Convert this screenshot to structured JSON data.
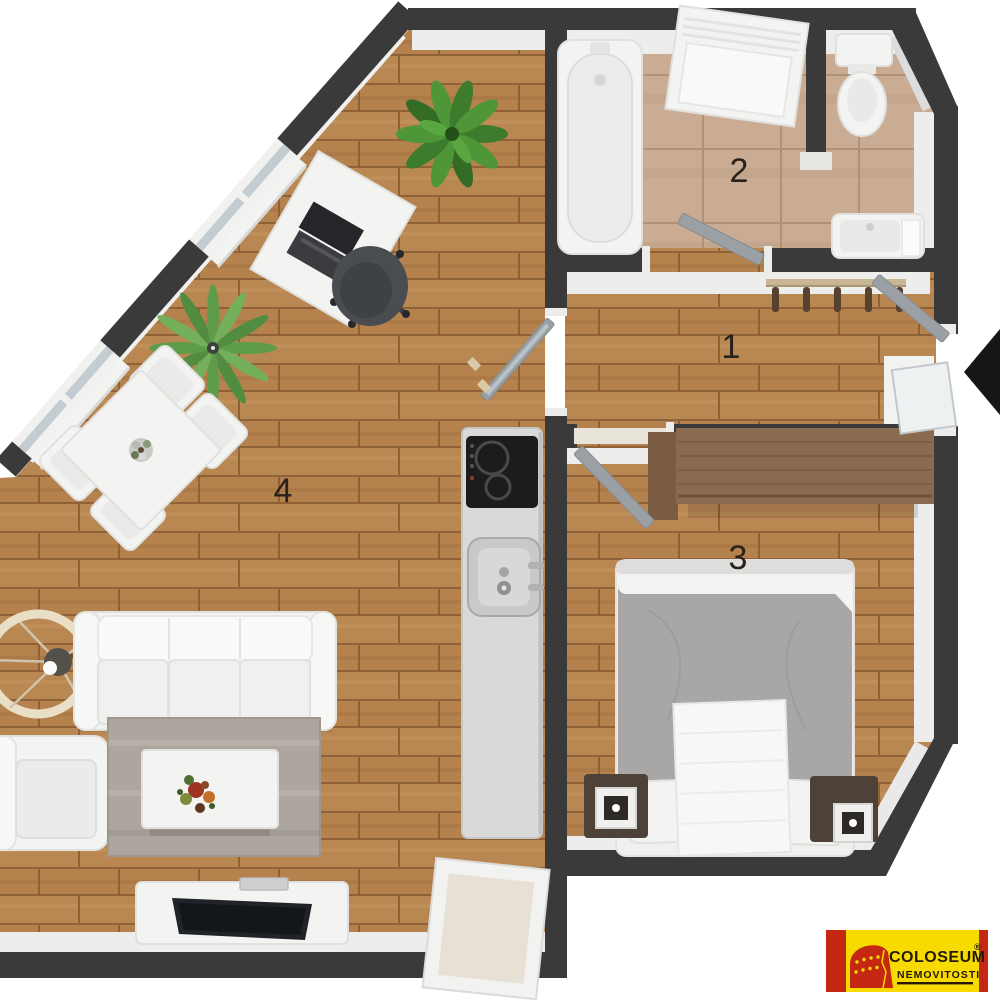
{
  "rooms": {
    "hall": {
      "label": "1"
    },
    "bathroom": {
      "label": "2"
    },
    "bedroom": {
      "label": "3"
    },
    "living_room": {
      "label": "4"
    }
  },
  "logo": {
    "brand": "COLOSEUM",
    "registered_mark": "®",
    "subtitle": "NEMOVITOSTI"
  },
  "icons": {
    "entrance_arrow": "left-pointing-arrowhead",
    "logo_mark": "colosseum-building"
  },
  "furniture": {
    "bathroom": [
      "bathtub",
      "shower-unit",
      "toilet",
      "wc-partition",
      "wash-basin"
    ],
    "hall": [
      "coat-rack",
      "entrance-door",
      "entrance-sidelight"
    ],
    "bedroom": [
      "wardrobe",
      "double-bed",
      "pillows",
      "white-runner",
      "nightstand-left",
      "nightstand-right",
      "bedroom-door"
    ],
    "living_room": [
      "desk",
      "laptop",
      "office-chair",
      "potted-plant",
      "fern-plant",
      "dining-table",
      "dining-chair-north",
      "dining-chair-east",
      "dining-chair-south",
      "dining-chair-west",
      "flower-centerpiece",
      "pendant-lamp",
      "sofa",
      "armchair",
      "rug",
      "coffee-table",
      "flower-bouquet",
      "tv-stand",
      "tv",
      "balcony-door",
      "glass-door"
    ],
    "kitchen": [
      "kitchen-counter",
      "cooktop",
      "sink"
    ]
  },
  "colors": {
    "wall": "#3a3a3a",
    "wood_floor": "#b5824e",
    "tile_floor": "#c9ac93",
    "inner_wall_face": "#ededec",
    "furniture_white": "#f3f3f1",
    "furniture_outline": "#e0e0de",
    "door_gray": "#9aa0a4",
    "duvet_gray": "#a8a7a5",
    "wardrobe_wood": "#8a6b50",
    "nightstand_brown": "#4e4138",
    "rug_gray": "#aca69e",
    "counter_gray": "#d9d9d9",
    "cooktop_black": "#1c1c1c",
    "arrow_black": "#161616",
    "label_color": "#2b211b",
    "logo_yellow": "#f7da00",
    "logo_red": "#c42812",
    "logo_text": "#241a04"
  }
}
